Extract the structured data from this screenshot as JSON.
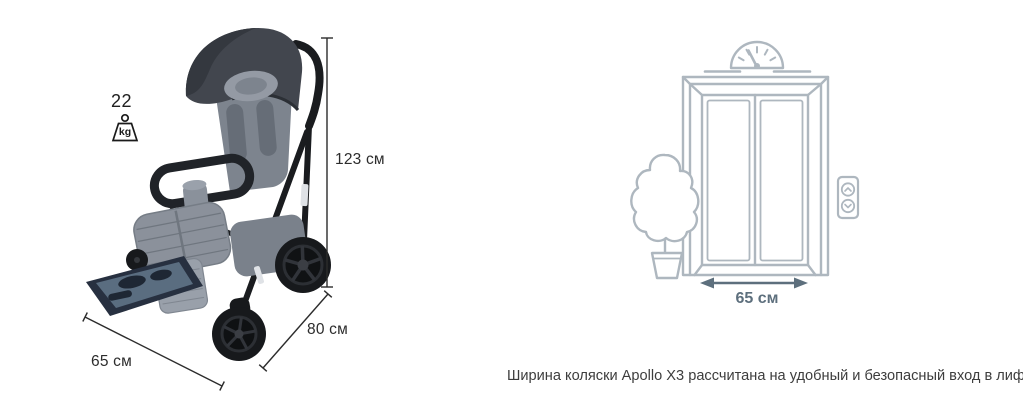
{
  "figure": {
    "stroller": {
      "weight_value": "22",
      "weight_unit": "kg",
      "height_label": "123 см",
      "depth_label": "80 см",
      "width_label": "65 см"
    },
    "elevator": {
      "door_width_label": "65 см"
    },
    "caption": "Ширина коляски Apollo X3 рассчитана на удобный и безопасный вход в лифт.",
    "colors": {
      "background": "#ffffff",
      "dimension_text": "#2c2c2c",
      "caption_text": "#3d3d3d",
      "elevator_line": "#aeb7bf",
      "elevator_accent": "#5d6f7d",
      "stroller_frame": "#1a1c1f",
      "stroller_fabric": "#8a919b",
      "canopy": "#42464e"
    }
  }
}
